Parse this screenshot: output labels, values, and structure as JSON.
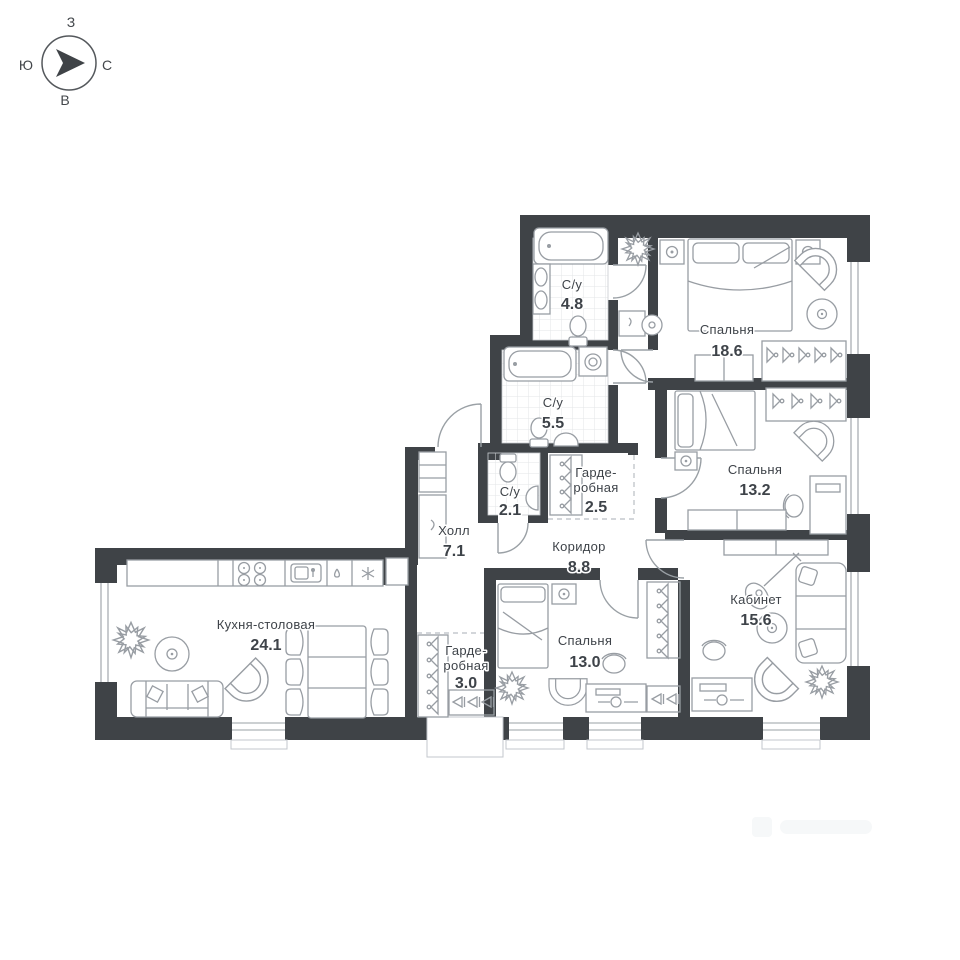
{
  "page": {
    "background": "#ffffff",
    "type": "apartment floor plan"
  },
  "colors": {
    "wall": "#3f4347",
    "furniture_stroke": "#989da3",
    "tile_stroke": "#e3e5e7",
    "text": "#3e4349",
    "door_stroke": "#9aa0a5",
    "dash_stroke": "#b9bec3"
  },
  "compass": {
    "top": "З",
    "left": "Ю",
    "right": "С",
    "bottom": "В"
  },
  "rooms": [
    {
      "id": "bathroom-1",
      "name": "С/у",
      "area": "4.8"
    },
    {
      "id": "bedroom-1",
      "name": "Спальня",
      "area": "18.6"
    },
    {
      "id": "bathroom-2",
      "name": "С/у",
      "area": "5.5"
    },
    {
      "id": "wardrobe-1",
      "name_line1": "Гарде-",
      "name_line2": "робная",
      "area": "2.5"
    },
    {
      "id": "bathroom-3",
      "name": "С/у",
      "area": "2.1"
    },
    {
      "id": "hall",
      "name": "Холл",
      "area": "7.1"
    },
    {
      "id": "corridor",
      "name": "Коридор",
      "area": "8.8"
    },
    {
      "id": "bedroom-2",
      "name": "Спальня",
      "area": "13.2"
    },
    {
      "id": "office",
      "name": "Кабинет",
      "area": "15.6"
    },
    {
      "id": "bedroom-3",
      "name": "Спальня",
      "area": "13.0"
    },
    {
      "id": "kitchen-dining",
      "name": "Кухня-столовая",
      "area": "24.1"
    },
    {
      "id": "wardrobe-2",
      "name_line1": "Гарде-",
      "name_line2": "робная",
      "area": "3.0"
    }
  ]
}
